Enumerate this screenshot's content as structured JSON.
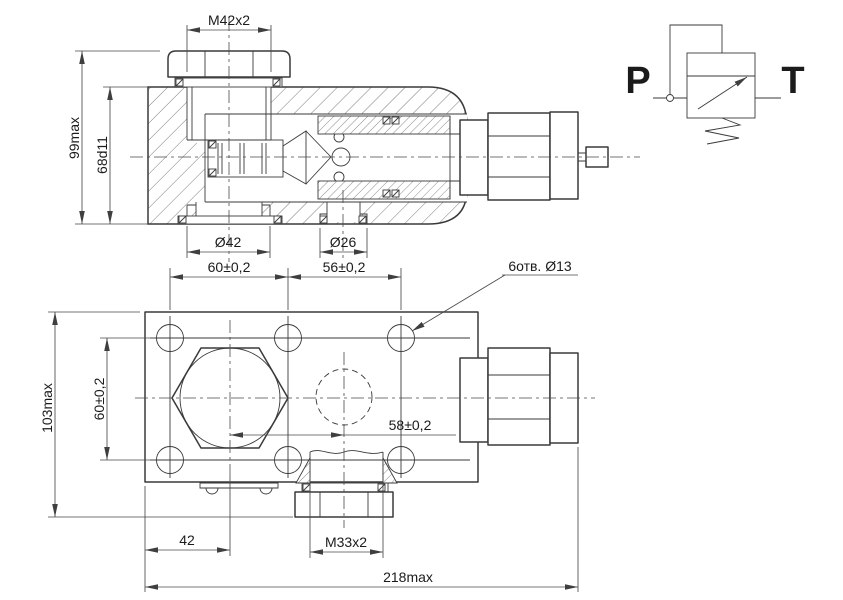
{
  "colors": {
    "background": "#ffffff",
    "outline": "#3a3a3a",
    "dimension_line": "#4a4a4a",
    "text": "#1b1b1b"
  },
  "section_view": {
    "dim_thread_top": "M42x2",
    "dim_height_overall": "99max",
    "dim_bore_height": "68d11",
    "dim_boss_diameter": "Ø42",
    "dim_port_diameter": "Ø26"
  },
  "hole_pattern": {
    "dim_spacing_left": "60±0,2",
    "dim_spacing_right": "56±0,2",
    "note_holes": "6отв. Ø13"
  },
  "plan_view": {
    "dim_height_overall": "103max",
    "dim_hole_spacing_vertical": "60±0,2",
    "dim_port_center_spacing": "58±0,2",
    "dim_edge_to_plug_axis": "42",
    "dim_thread_bottom": "M33x2",
    "dim_length_overall": "218max"
  },
  "schematic": {
    "port_inlet": "P",
    "port_outlet": "T"
  }
}
